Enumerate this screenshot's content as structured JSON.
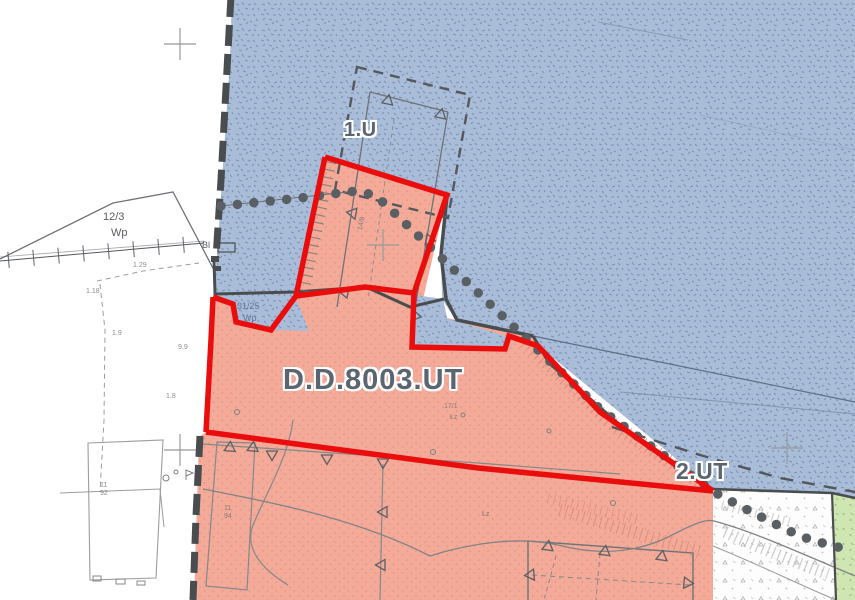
{
  "map": {
    "type": "zoning-plan",
    "zones": {
      "unit_1": {
        "label": "1.U"
      },
      "unit_main": {
        "label": "D.D.8003.UT"
      },
      "unit_2": {
        "label": "2.UT"
      }
    },
    "parcels": {
      "p12_3": "12/3",
      "wp_left": "Wp",
      "bl": "Bl",
      "p31_25": "31/25",
      "wp_wedge": "Wp"
    },
    "micro_labels": [
      {
        "text": "14/8",
        "x": 355,
        "y": 220,
        "rot": -78
      },
      {
        "text": "17/1",
        "x": 444,
        "y": 403,
        "rot": 0
      },
      {
        "text": "Łz",
        "x": 450,
        "y": 414,
        "rot": 0
      },
      {
        "text": "Łz",
        "x": 482,
        "y": 511,
        "rot": 0
      },
      {
        "text": "1.29",
        "x": 133,
        "y": 262,
        "rot": 0
      },
      {
        "text": "1.18",
        "x": 86,
        "y": 288,
        "rot": 0
      },
      {
        "text": "1.9",
        "x": 112,
        "y": 330,
        "rot": 0
      },
      {
        "text": "9.9",
        "x": 178,
        "y": 344,
        "rot": 0
      },
      {
        "text": "1.8",
        "x": 166,
        "y": 393,
        "rot": 0
      },
      {
        "text": "11",
        "x": 100,
        "y": 482,
        "rot": 0
      },
      {
        "text": "92",
        "x": 100,
        "y": 490,
        "rot": 0
      },
      {
        "text": "11",
        "x": 224,
        "y": 505,
        "rot": 0
      },
      {
        "text": "94",
        "x": 224,
        "y": 513,
        "rot": 0
      }
    ],
    "colors": {
      "water_blue": "#a9bdd9",
      "blue_mark": "#7c92b6",
      "resort_salmon": "#f4aa98",
      "salmon_dot": "#e2907e",
      "boundary_red": "#ea0d0d",
      "forest_green": "#cfe5b2",
      "green_mark": "#9fbe7e",
      "line_dark": "#4a4d50",
      "line_gray": "#85888b",
      "label_gray": "#5b6570",
      "dot_gray": "#595f63"
    }
  }
}
